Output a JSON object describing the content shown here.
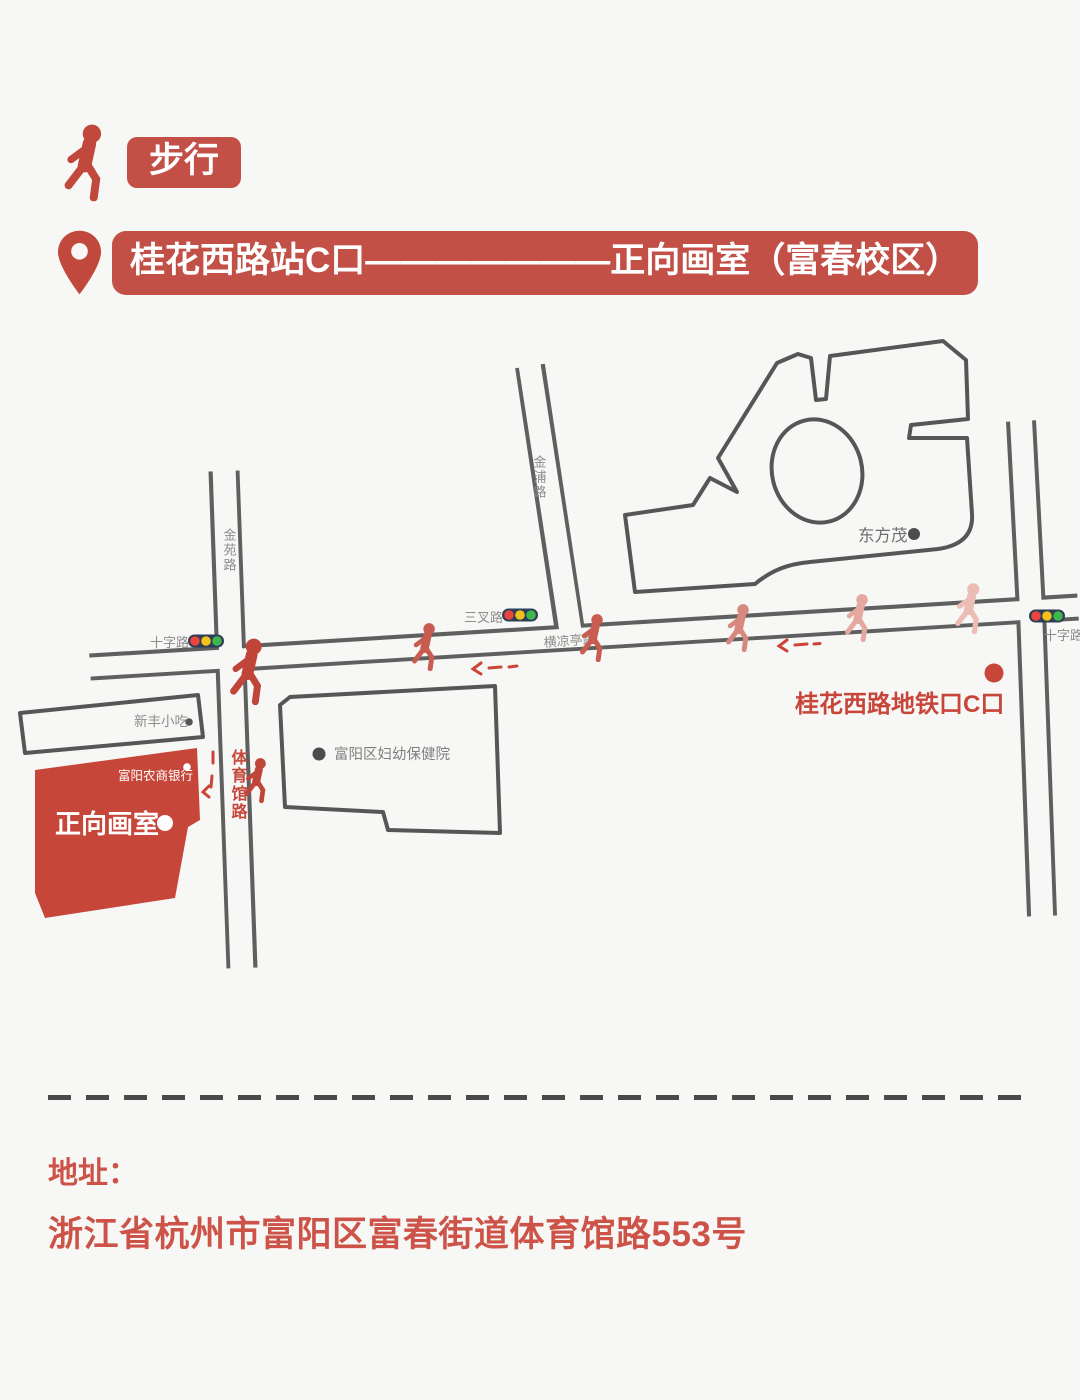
{
  "header": {
    "mode_badge": "步行",
    "route": "桂花西路站C口———————正向画室（富春校区）"
  },
  "map": {
    "road_labels": {
      "jinyuan": "金苑路",
      "jinpu": "金浦路",
      "crossroad_left": "十字路",
      "sancha": "三叉路",
      "hengliangting": "横凉亭路",
      "crossroad_right": "十字路",
      "tiyuguan": "体育馆路"
    },
    "places": {
      "dongfangmao": "东方茂",
      "xinfeng_snacks": "新丰小吃",
      "fuyang_rural_commercial_bank": "富阳农商银行",
      "fuyang_maternal_child_hospital": "富阳区妇幼保健院",
      "zhengxiang_studio": "正向画室",
      "metro_exit": "桂花西路地铁口C口"
    },
    "colors": {
      "background": "#f7f7f5",
      "accent_red": "#c25047",
      "studio_building_red": "#c7463a",
      "metro_label_red": "#c8453a",
      "tiyuguan_label_red": "#c5483c",
      "road_line": "#5f5f5f",
      "building_outline": "#565656",
      "road_label_gray": "#8c8c8c",
      "traffic_light_body": "#2d3d57",
      "traffic_red": "#e8453e",
      "traffic_yellow": "#f2c21c",
      "traffic_green": "#3fb84b",
      "arrow_red": "#cc4437",
      "walkers": [
        "#bf4539",
        "#c95c50",
        "#c95c50",
        "#d8897e",
        "#e5a89f",
        "#ecbdb5",
        "#bf4539"
      ]
    }
  },
  "footer": {
    "address_label": "地址：",
    "address": "浙江省杭州市富阳区富春街道体育馆路553号"
  }
}
